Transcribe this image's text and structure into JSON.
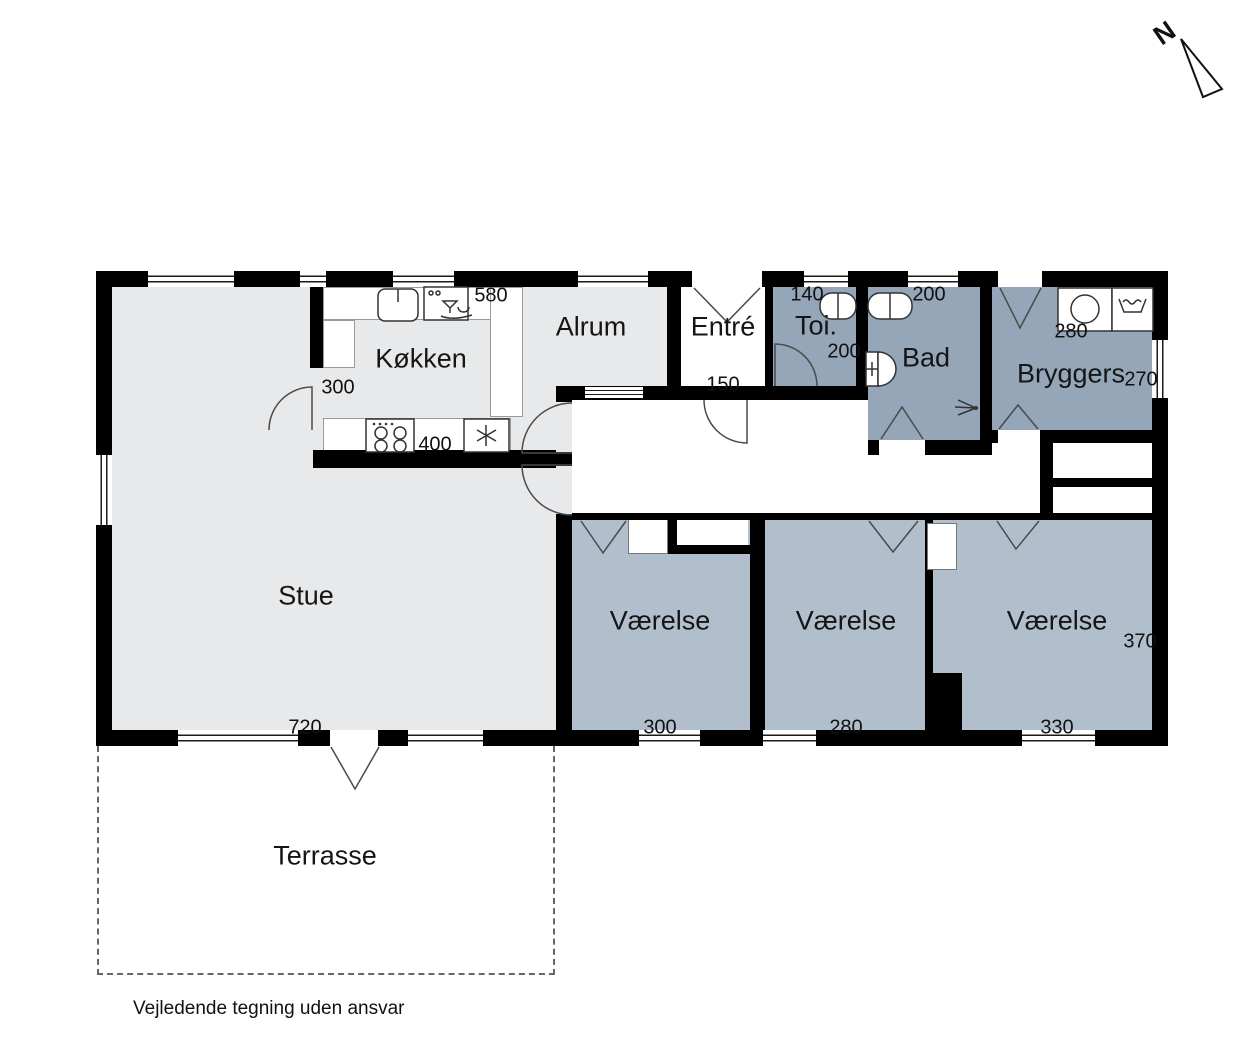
{
  "note": "Vejledende tegning uden ansvar",
  "compass": {
    "label": "N"
  },
  "rooms": {
    "stue": "Stue",
    "kokken": "Køkken",
    "alrum": "Alrum",
    "entre": "Entré",
    "toi": "Toi.",
    "bad": "Bad",
    "bryggers": "Bryggers",
    "vaerelse": "Værelse",
    "terrasse": "Terrasse"
  },
  "dimensions": {
    "kokken_counter_top": "580",
    "kokken_opening": "300",
    "kokken_counter_bottom": "400",
    "entre_width": "150",
    "toi_width": "140",
    "toi_depth": "200",
    "bad_width": "200",
    "bryggers_width": "280",
    "bryggers_depth": "270",
    "stue_width": "720",
    "vaerelse1_width": "300",
    "vaerelse2_width": "280",
    "vaerelse3_width": "330",
    "vaerelse3_depth": "370"
  },
  "colors": {
    "wall": "#000000",
    "room_light": "#e8e9eb",
    "room_medium": "#b1bfcc",
    "room_dark": "#94a6b8",
    "line": "#4a4a4a"
  },
  "icons": [
    "north-arrow-icon",
    "sink-icon",
    "dishwasher-icon",
    "stove-icon",
    "freezer-icon",
    "washing-machine-icon",
    "laundry-sink-icon",
    "vanity-icon",
    "toilet-icon",
    "shower-icon",
    "door-swing-icon",
    "window-icon"
  ]
}
